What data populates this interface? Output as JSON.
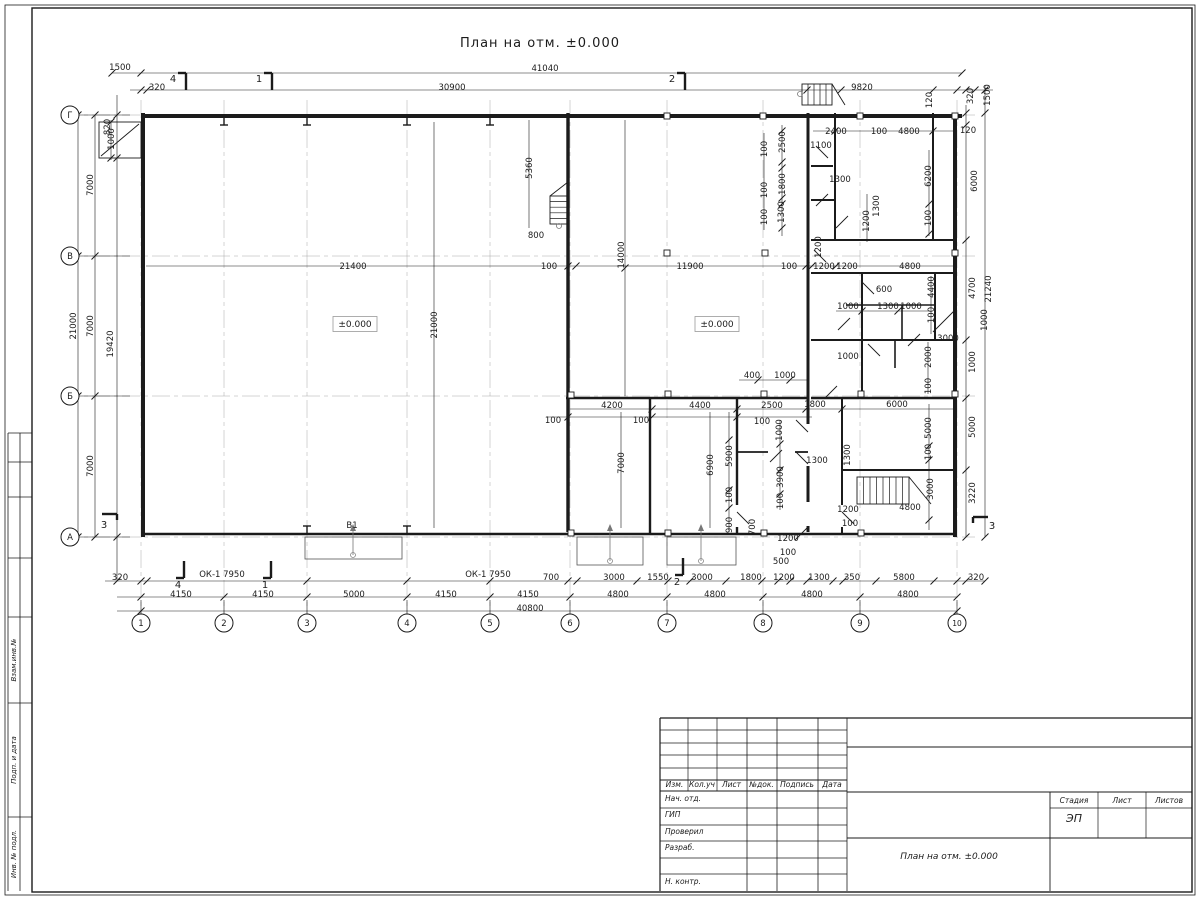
{
  "sheet": {
    "title": "План на отм. ±0.000",
    "ink": "#1b1b1b",
    "bg": "#ffffff"
  },
  "frame": {
    "stamp_labels": [
      "Взам.инв.№",
      "Подп. и дата",
      "Инв. № подл."
    ]
  },
  "titleblock": {
    "headers": [
      "Изм.",
      "Кол.уч",
      "Лист",
      "№док.",
      "Подпись",
      "Дата"
    ],
    "sign_rows": [
      "Нач. отд.",
      "ГИП",
      "Проверил",
      "Разраб.",
      "",
      "Н. контр."
    ],
    "stage_headers": [
      "Стадия",
      "Лист",
      "Листов"
    ],
    "stage_value": "ЭП",
    "doc_title": "План на отм. ±0.000"
  },
  "plan": {
    "axes": {
      "letters": [
        "Г",
        "В",
        "Б",
        "А"
      ],
      "letter_y": [
        115,
        256,
        396,
        537
      ],
      "numbers": [
        "1",
        "2",
        "3",
        "4",
        "5",
        "6",
        "7",
        "8",
        "9",
        "10"
      ],
      "number_x": [
        141,
        224,
        307,
        407,
        490,
        570,
        667,
        763,
        860,
        957
      ],
      "circle_left_x": 70,
      "circle_bottom_y": 623,
      "radius": 9
    },
    "levels": [
      {
        "t": "±0.000",
        "x": 355,
        "y": 324
      },
      {
        "t": "±0.000",
        "x": 717,
        "y": 324
      }
    ],
    "labels": [
      [
        "1500",
        120,
        67
      ],
      [
        "41040",
        545,
        68
      ],
      [
        "320",
        157,
        87
      ],
      [
        "30900",
        452,
        87
      ],
      [
        "9820",
        862,
        87
      ],
      [
        "820",
        107,
        127,
        1
      ],
      [
        "1000",
        111,
        139,
        1
      ],
      [
        "120",
        929,
        100,
        1
      ],
      [
        "320",
        970,
        96,
        1
      ],
      [
        "1500",
        987,
        95,
        1
      ],
      [
        "120",
        968,
        130
      ],
      [
        "7000",
        90,
        185,
        1
      ],
      [
        "21000",
        73,
        326,
        1
      ],
      [
        "7000",
        90,
        326,
        1
      ],
      [
        "19420",
        110,
        344,
        1
      ],
      [
        "7000",
        90,
        466,
        1
      ],
      [
        "320",
        120,
        577
      ],
      [
        "ОК-1 7950",
        222,
        574
      ],
      [
        "ОК-1 7950",
        488,
        574
      ],
      [
        "700",
        551,
        577
      ],
      [
        "3000",
        614,
        577
      ],
      [
        "1550",
        658,
        577
      ],
      [
        "3000",
        702,
        577
      ],
      [
        "1800",
        751,
        577
      ],
      [
        "500",
        781,
        561
      ],
      [
        "1200",
        784,
        577
      ],
      [
        "1300",
        819,
        577
      ],
      [
        "350",
        852,
        577
      ],
      [
        "5800",
        904,
        577
      ],
      [
        "320",
        976,
        577
      ],
      [
        "4150",
        181,
        594
      ],
      [
        "4150",
        263,
        594
      ],
      [
        "5000",
        354,
        594
      ],
      [
        "4150",
        446,
        594
      ],
      [
        "4150",
        528,
        594
      ],
      [
        "4800",
        618,
        594
      ],
      [
        "4800",
        715,
        594
      ],
      [
        "4800",
        812,
        594
      ],
      [
        "4800",
        908,
        594
      ],
      [
        "40800",
        530,
        608
      ],
      [
        "6000",
        974,
        181,
        1
      ],
      [
        "4700",
        972,
        288,
        1
      ],
      [
        "21240",
        988,
        289,
        1
      ],
      [
        "1000",
        984,
        320,
        1
      ],
      [
        "1000",
        972,
        362,
        1
      ],
      [
        "5000",
        972,
        427,
        1
      ],
      [
        "3220",
        972,
        493,
        1
      ],
      [
        "21400",
        353,
        266
      ],
      [
        "100",
        549,
        266
      ],
      [
        "21000",
        434,
        325,
        1
      ],
      [
        "5360",
        529,
        168,
        1
      ],
      [
        "800",
        536,
        235
      ],
      [
        "14000",
        621,
        255,
        1
      ],
      [
        "11900",
        690,
        266
      ],
      [
        "100",
        789,
        266
      ],
      [
        "1200",
        824,
        266
      ],
      [
        "1200",
        847,
        266
      ],
      [
        "4800",
        910,
        266
      ],
      [
        "1200",
        818,
        247,
        1
      ],
      [
        "2400",
        836,
        131
      ],
      [
        "100",
        879,
        131
      ],
      [
        "4800",
        909,
        131
      ],
      [
        "1100",
        821,
        145
      ],
      [
        "2500",
        782,
        142,
        1
      ],
      [
        "100",
        764,
        149,
        1
      ],
      [
        "1800",
        782,
        184,
        1
      ],
      [
        "100",
        764,
        190,
        1
      ],
      [
        "1300",
        840,
        179
      ],
      [
        "1300",
        876,
        206,
        1
      ],
      [
        "1200",
        866,
        221,
        1
      ],
      [
        "1300",
        781,
        212,
        1
      ],
      [
        "100",
        764,
        217,
        1
      ],
      [
        "6200",
        928,
        176,
        1
      ],
      [
        "100",
        928,
        218,
        1
      ],
      [
        "600",
        884,
        289
      ],
      [
        "1000",
        848,
        306
      ],
      [
        "1300",
        888,
        306
      ],
      [
        "1000",
        911,
        306
      ],
      [
        "4400",
        931,
        287,
        1
      ],
      [
        "100",
        931,
        315,
        1
      ],
      [
        "3000",
        948,
        338
      ],
      [
        "1000",
        848,
        356
      ],
      [
        "2000",
        928,
        357,
        1
      ],
      [
        "100",
        928,
        386,
        1
      ],
      [
        "1800",
        815,
        404
      ],
      [
        "6000",
        897,
        404
      ],
      [
        "400",
        752,
        375
      ],
      [
        "1000",
        785,
        375
      ],
      [
        "4200",
        612,
        405
      ],
      [
        "4400",
        700,
        405
      ],
      [
        "2500",
        772,
        405
      ],
      [
        "100",
        553,
        420
      ],
      [
        "100",
        641,
        420
      ],
      [
        "100",
        762,
        421
      ],
      [
        "1000",
        779,
        430,
        1
      ],
      [
        "7000",
        621,
        463,
        1
      ],
      [
        "6900",
        710,
        465,
        1
      ],
      [
        "5900",
        729,
        456,
        1
      ],
      [
        "100",
        729,
        495,
        1
      ],
      [
        "900",
        729,
        525,
        1
      ],
      [
        "3900",
        780,
        477,
        1
      ],
      [
        "100",
        780,
        501,
        1
      ],
      [
        "1300",
        817,
        460
      ],
      [
        "1300",
        847,
        455,
        1
      ],
      [
        "700",
        752,
        527,
        1
      ],
      [
        "1200",
        788,
        538
      ],
      [
        "100",
        788,
        552
      ],
      [
        "1200",
        848,
        509
      ],
      [
        "100",
        850,
        523
      ],
      [
        "4800",
        910,
        507
      ],
      [
        "3000",
        930,
        489,
        1
      ],
      [
        "5000",
        928,
        428,
        1
      ],
      [
        "100",
        928,
        452,
        1
      ],
      [
        "В1",
        352,
        525
      ]
    ],
    "sections": [
      [
        "4",
        186,
        82,
        "top"
      ],
      [
        "1",
        272,
        82,
        "top"
      ],
      [
        "2",
        685,
        82,
        "top"
      ],
      [
        "4",
        184,
        569,
        "bot"
      ],
      [
        "1",
        271,
        569,
        "bot"
      ],
      [
        "2",
        683,
        566,
        "bot"
      ],
      [
        "3",
        107,
        514,
        "left"
      ],
      [
        "3",
        983,
        517,
        "right"
      ]
    ],
    "chains": [
      {
        "o": "h",
        "p": 73,
        "a": 112,
        "b": 962,
        "t": [
          112,
          141,
          962
        ]
      },
      {
        "o": "h",
        "p": 90,
        "a": 130,
        "b": 993,
        "t": [
          141,
          147,
          807,
          841,
          933,
          957,
          966,
          975,
          985
        ]
      },
      {
        "o": "h",
        "p": 581,
        "a": 105,
        "b": 985,
        "t": [
          117,
          141,
          147,
          307,
          407,
          490,
          568,
          577,
          637,
          668,
          690,
          726,
          762,
          778,
          790,
          807,
          833,
          843,
          876,
          934,
          957,
          966,
          985
        ]
      },
      {
        "o": "h",
        "p": 597,
        "a": 117,
        "b": 957,
        "t": [
          141,
          224,
          307,
          407,
          490,
          570,
          667,
          763,
          860,
          957
        ]
      },
      {
        "o": "h",
        "p": 611,
        "a": 117,
        "b": 957,
        "t": [
          141,
          957
        ]
      },
      {
        "o": "v",
        "p": 78,
        "a": 115,
        "b": 537,
        "t": [
          115,
          256,
          396,
          537
        ]
      },
      {
        "o": "v",
        "p": 95,
        "a": 115,
        "b": 537,
        "t": [
          115,
          256,
          396,
          537
        ]
      },
      {
        "o": "v",
        "p": 117,
        "a": 95,
        "b": 581,
        "t": [
          115,
          158,
          537
        ]
      },
      {
        "o": "v",
        "p": 966,
        "a": 105,
        "b": 537,
        "t": [
          113,
          125,
          240,
          340,
          398,
          470,
          537
        ]
      },
      {
        "o": "v",
        "p": 985,
        "a": 85,
        "b": 537,
        "t": [
          113,
          537
        ]
      },
      {
        "o": "h",
        "p": 266,
        "a": 146,
        "b": 955,
        "t": [
          568,
          576,
          806,
          812,
          836
        ]
      },
      {
        "o": "h",
        "p": 131,
        "a": 813,
        "b": 955,
        "t": [
          835,
          933
        ]
      },
      {
        "o": "h",
        "p": 409,
        "a": 570,
        "b": 955,
        "t": [
          652,
          737,
          806,
          842
        ]
      },
      {
        "o": "h",
        "p": 417,
        "a": 546,
        "b": 812,
        "t": [
          568,
          652,
          737
        ]
      },
      {
        "o": "h",
        "p": 311,
        "a": 836,
        "b": 930,
        "t": [
          862,
          898
        ]
      },
      {
        "o": "h",
        "p": 380,
        "a": 739,
        "b": 808,
        "t": [
          758,
          790
        ]
      },
      {
        "o": "v",
        "p": 434,
        "a": 122,
        "b": 528,
        "t": []
      },
      {
        "o": "v",
        "p": 625,
        "a": 120,
        "b": 396,
        "t": [
          268
        ]
      },
      {
        "o": "v",
        "p": 621,
        "a": 412,
        "b": 528,
        "t": []
      },
      {
        "o": "v",
        "p": 710,
        "a": 412,
        "b": 528,
        "t": []
      },
      {
        "o": "v",
        "p": 729,
        "a": 412,
        "b": 532,
        "t": [
          440,
          490,
          508
        ]
      },
      {
        "o": "v",
        "p": 780,
        "a": 420,
        "b": 510,
        "t": [
          444,
          470,
          494
        ]
      },
      {
        "o": "v",
        "p": 929,
        "a": 404,
        "b": 530,
        "t": [
          446,
          460,
          520
        ]
      },
      {
        "o": "v",
        "p": 928,
        "a": 342,
        "b": 394,
        "t": []
      },
      {
        "o": "v",
        "p": 931,
        "a": 276,
        "b": 334,
        "t": []
      },
      {
        "o": "v",
        "p": 782,
        "a": 125,
        "b": 236,
        "t": [
          131,
          162,
          168,
          198,
          204,
          228
        ]
      },
      {
        "o": "v",
        "p": 764,
        "a": 133,
        "b": 230,
        "t": []
      },
      {
        "o": "v",
        "p": 867,
        "a": 194,
        "b": 242,
        "t": []
      },
      {
        "o": "v",
        "p": 929,
        "a": 150,
        "b": 236,
        "t": [
          204,
          234
        ]
      },
      {
        "o": "v",
        "p": 529,
        "a": 120,
        "b": 228,
        "t": []
      },
      {
        "o": "v",
        "p": 111,
        "a": 120,
        "b": 160,
        "t": [
          122,
          158
        ]
      }
    ],
    "walls": [
      [
        141,
        116,
        962,
        116,
        4
      ],
      [
        143,
        113,
        143,
        537,
        4
      ],
      [
        141,
        534,
        957,
        534,
        2.6
      ],
      [
        955,
        113,
        955,
        537,
        4
      ],
      [
        568,
        113,
        568,
        532,
        3.4
      ],
      [
        808,
        113,
        808,
        424,
        3
      ],
      [
        808,
        466,
        808,
        502,
        3
      ],
      [
        808,
        526,
        808,
        532,
        3
      ],
      [
        811,
        240,
        955,
        240,
        2
      ],
      [
        835,
        113,
        835,
        240,
        2
      ],
      [
        933,
        113,
        933,
        240,
        2
      ],
      [
        811,
        166,
        833,
        166,
        2
      ],
      [
        811,
        200,
        835,
        200,
        2
      ],
      [
        811,
        273,
        955,
        273,
        2
      ],
      [
        862,
        273,
        862,
        340,
        2
      ],
      [
        935,
        273,
        935,
        340,
        2
      ],
      [
        846,
        305,
        935,
        305,
        1.6
      ],
      [
        902,
        305,
        902,
        340,
        1.6
      ],
      [
        811,
        340,
        955,
        340,
        2
      ],
      [
        862,
        340,
        862,
        398,
        2
      ],
      [
        895,
        340,
        895,
        368,
        1.6
      ],
      [
        566,
        398,
        808,
        398,
        2.6
      ],
      [
        811,
        398,
        955,
        398,
        2.6
      ],
      [
        842,
        398,
        842,
        505,
        2
      ],
      [
        842,
        527,
        842,
        534,
        2
      ],
      [
        842,
        470,
        955,
        470,
        2
      ],
      [
        650,
        398,
        650,
        534,
        2.4
      ],
      [
        737,
        398,
        737,
        505,
        2.4
      ],
      [
        737,
        527,
        737,
        534,
        2.4
      ],
      [
        737,
        452,
        768,
        452,
        1.8
      ],
      [
        795,
        452,
        808,
        452,
        1.8
      ]
    ],
    "doors": [
      [
        816,
        146,
        828,
        158
      ],
      [
        816,
        206,
        828,
        194
      ],
      [
        814,
        250,
        826,
        262
      ],
      [
        836,
        228,
        848,
        216
      ],
      [
        862,
        282,
        874,
        294
      ],
      [
        838,
        330,
        850,
        318
      ],
      [
        868,
        344,
        880,
        356
      ],
      [
        808,
        432,
        796,
        420
      ],
      [
        808,
        464,
        796,
        452
      ],
      [
        737,
        512,
        749,
        524
      ],
      [
        842,
        512,
        854,
        524
      ],
      [
        795,
        540,
        807,
        528
      ],
      [
        908,
        346,
        920,
        334
      ],
      [
        933,
        332,
        955,
        310
      ],
      [
        101,
        156,
        139,
        124
      ],
      [
        770,
        462,
        782,
        450
      ],
      [
        825,
        398,
        837,
        386
      ]
    ],
    "squares": [
      [
        667,
        116
      ],
      [
        763,
        116
      ],
      [
        860,
        116
      ],
      [
        955,
        116
      ],
      [
        667,
        253
      ],
      [
        765,
        253
      ],
      [
        955,
        253
      ],
      [
        571,
        395
      ],
      [
        668,
        394
      ],
      [
        764,
        394
      ],
      [
        861,
        394
      ],
      [
        955,
        394
      ],
      [
        571,
        533
      ],
      [
        668,
        533
      ],
      [
        764,
        533
      ],
      [
        861,
        533
      ]
    ],
    "ibeams": [
      [
        224,
        121
      ],
      [
        307,
        121
      ],
      [
        407,
        121
      ],
      [
        490,
        121
      ],
      [
        307,
        530
      ],
      [
        407,
        530
      ]
    ],
    "stairs": [
      {
        "x": 550,
        "y": 196,
        "w": 18,
        "h": 28,
        "n": 5,
        "dir": "v",
        "diag": [
          550,
          196,
          568,
          182
        ],
        "circle": [
          559,
          226
        ]
      },
      {
        "x": 802,
        "y": 84,
        "w": 30,
        "h": 21,
        "n": 5,
        "dir": "h",
        "diag": [
          832,
          84,
          845,
          105
        ],
        "circle": [
          800,
          94
        ]
      },
      {
        "x": 857,
        "y": 477,
        "w": 52,
        "h": 27,
        "n": 8,
        "dir": "h",
        "diag": [
          909,
          477,
          931,
          504
        ],
        "circle": null
      }
    ],
    "porches": [
      [
        305,
        537,
        97,
        22,
        353
      ],
      [
        577,
        537,
        66,
        28,
        610
      ],
      [
        667,
        537,
        69,
        28,
        701
      ]
    ],
    "corner_box": [
      99,
      122,
      42,
      36
    ]
  }
}
